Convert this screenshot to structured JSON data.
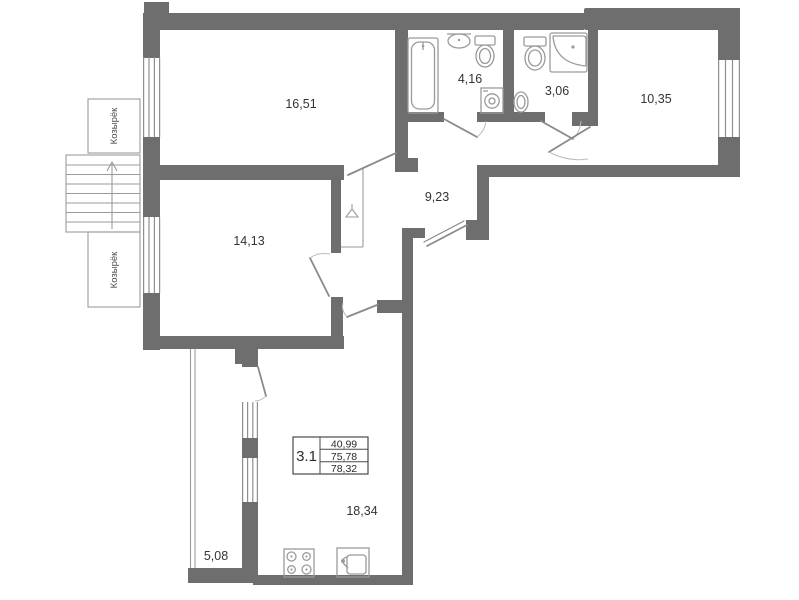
{
  "plan": {
    "unit": {
      "number": "3.1",
      "living_area": "40,99",
      "total_area": "75,78",
      "total_area_with_balcony": "78,32"
    },
    "rooms": {
      "room_1651": "16,51",
      "bathroom": "4,16",
      "wc": "3,06",
      "room_1035": "10,35",
      "hall": "9,23",
      "room_1413": "14,13",
      "kitchen_living": "18,34",
      "balcony": "5,08"
    },
    "annotations": {
      "canopy_top": "Козырёк",
      "canopy_bottom": "Козырёк"
    },
    "colors": {
      "wall": "#6e6e6e",
      "thin_line": "#8f8f8f",
      "text": "#333333"
    }
  }
}
